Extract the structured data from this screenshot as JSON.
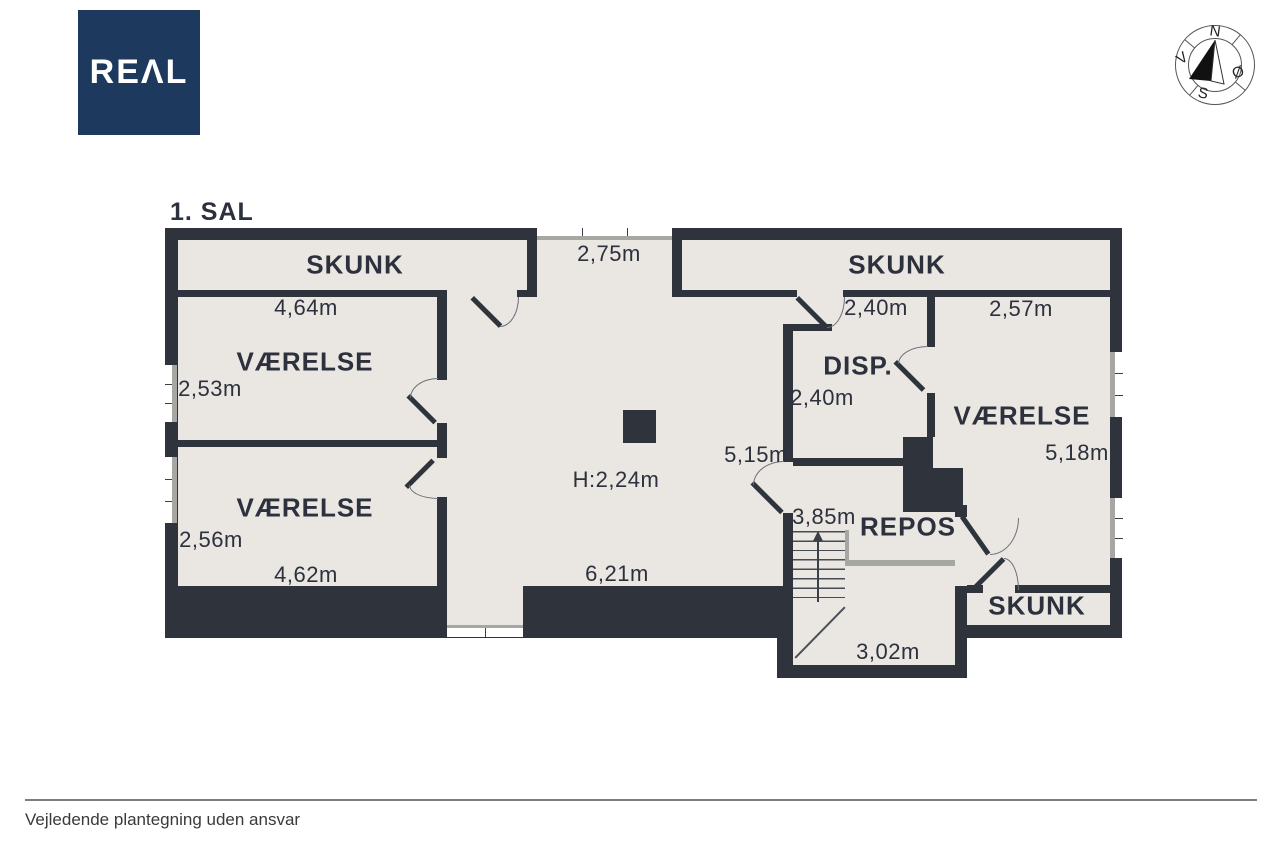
{
  "colors": {
    "wall": "#2e333c",
    "floor": "#eae6e1",
    "logo_bg": "#1d3a5e",
    "window_gray": "#a6a6a3",
    "footer_line": "#7d7d7d"
  },
  "header": {
    "logo_display": "REΛL",
    "logo_name": "REAL",
    "floor_title": "1. SAL"
  },
  "compass": {
    "north": "N",
    "east": "Ø",
    "south": "S",
    "west": "V"
  },
  "rooms": {
    "skunk_left": "SKUNK",
    "vaerelse_upper": "VÆRELSE",
    "vaerelse_lower": "VÆRELSE",
    "skunk_right": "SKUNK",
    "disp": "DISP.",
    "vaerelse_right": "VÆRELSE",
    "repos": "REPOS",
    "skunk_bottom": "SKUNK"
  },
  "dims": {
    "hall_top_width": "2,75m",
    "vaerelse_upper_width": "4,64m",
    "vaerelse_upper_depth": "2,53m",
    "vaerelse_lower_depth": "2,56m",
    "vaerelse_lower_width": "4,62m",
    "hall_ceiling_height": "H:2,24m",
    "hall_width": "6,21m",
    "hall_length": "5,15m",
    "skunk_right_width": "2,40m",
    "vaerelse_right_width": "2,57m",
    "disp_depth": "2,40m",
    "vaerelse_right_depth": "5,18m",
    "repos_width": "3,85m",
    "stair_width": "3,02m"
  },
  "footer": {
    "disclaimer": "Vejledende plantegning uden ansvar"
  }
}
